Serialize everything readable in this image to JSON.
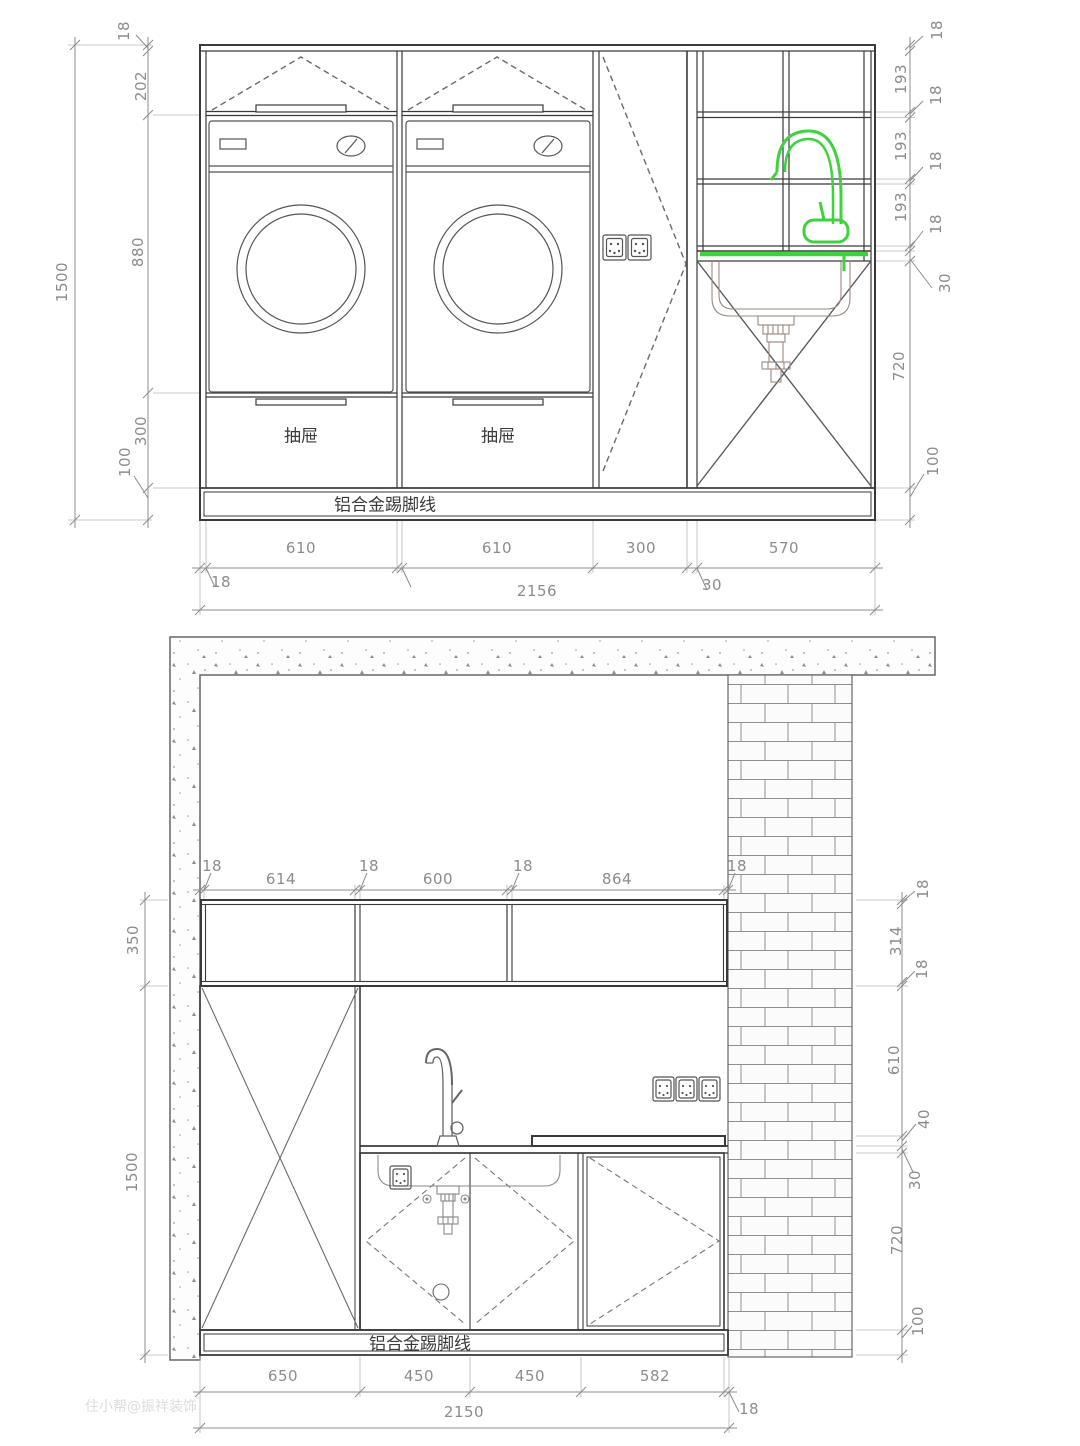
{
  "colors": {
    "line": "#3a3a3a",
    "dim": "#8c8c8c",
    "accent_green": "#3fd23f",
    "sink_detail": "#9a8a82"
  },
  "top_elevation": {
    "left": {
      "overall": "1500",
      "segments": [
        "18",
        "202",
        "880",
        "300",
        "100"
      ]
    },
    "right": {
      "segments": [
        "18",
        "193",
        "18",
        "193",
        "18",
        "193",
        "18",
        "30",
        "720",
        "100"
      ]
    },
    "bottom": {
      "segments": [
        "610",
        "18",
        "610",
        "300",
        "30",
        "570"
      ],
      "overall": "2156"
    },
    "drawer_label_1": "抽屉",
    "drawer_label_2": "抽屉",
    "kick_label": "铝合金踢脚线"
  },
  "bottom_elevation": {
    "top": {
      "segments": [
        "18",
        "614",
        "18",
        "600",
        "18",
        "864",
        "18"
      ]
    },
    "left": {
      "segments": [
        "350",
        "1500"
      ]
    },
    "right": {
      "segments": [
        "18",
        "314",
        "18",
        "610",
        "40",
        "30",
        "720",
        "100"
      ]
    },
    "bottom": {
      "segments": [
        "650",
        "450",
        "450",
        "582",
        "18"
      ],
      "overall": "2150"
    },
    "kick_label": "铝合金踢脚线"
  },
  "watermark": "住小帮@振祥装饰"
}
